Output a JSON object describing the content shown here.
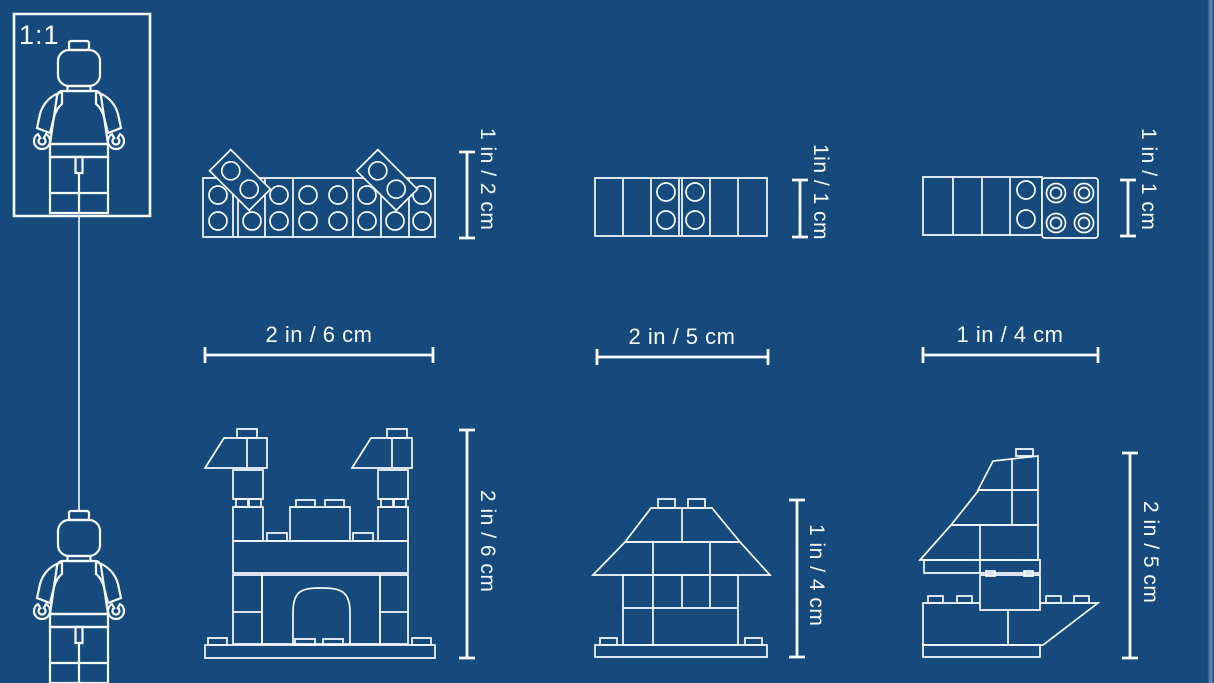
{
  "canvas": {
    "background": "#164A7D",
    "line_color": "#F7FAFC",
    "edge_highlight": "#9FB8CF"
  },
  "scale_reference": {
    "label": "1:1",
    "figure": "lego-minifigure-outline"
  },
  "models": [
    {
      "name": "brick-wall-top-view",
      "width_label": "2 in / 6 cm",
      "height_label": "1 in / 2 cm"
    },
    {
      "name": "brick-row-top-view",
      "width_label": "2 in / 5 cm",
      "height_label": "1in / 1 cm"
    },
    {
      "name": "brick-and-plate-top-view",
      "width_label": "1 in / 4 cm",
      "height_label": "1 in / 1 cm"
    },
    {
      "name": "castle-front-view",
      "height_label": "2 in / 6 cm"
    },
    {
      "name": "house-front-view",
      "height_label": "1 in / 4 cm"
    },
    {
      "name": "sailboat-side-view",
      "height_label": "2 in / 5 cm"
    }
  ]
}
